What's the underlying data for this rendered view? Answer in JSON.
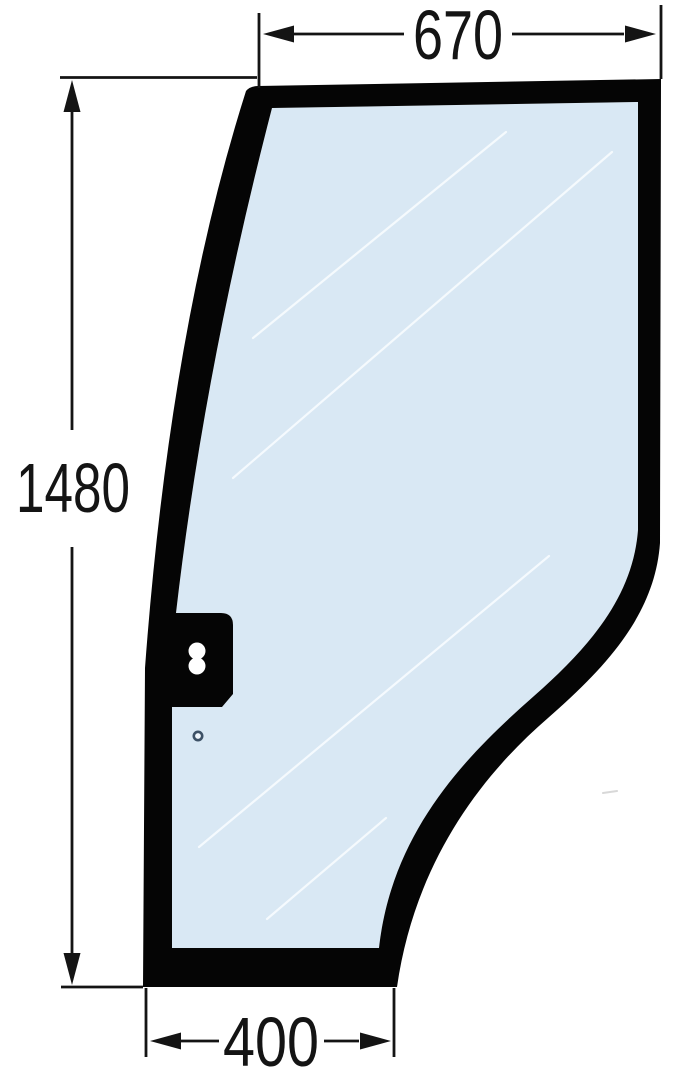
{
  "dimensions": {
    "top_width": "670",
    "overall_height": "1480",
    "bottom_width": "400"
  },
  "colors": {
    "background": "#ffffff",
    "glass": "#d9e8f4",
    "frame": "#050505",
    "dimension_lines": "#141414",
    "glass_streak": "#f7fbfe",
    "keyhole_cutout": "#ffffff",
    "hole_ring": "#3d5166",
    "hole_fill": "#eef5fb"
  }
}
